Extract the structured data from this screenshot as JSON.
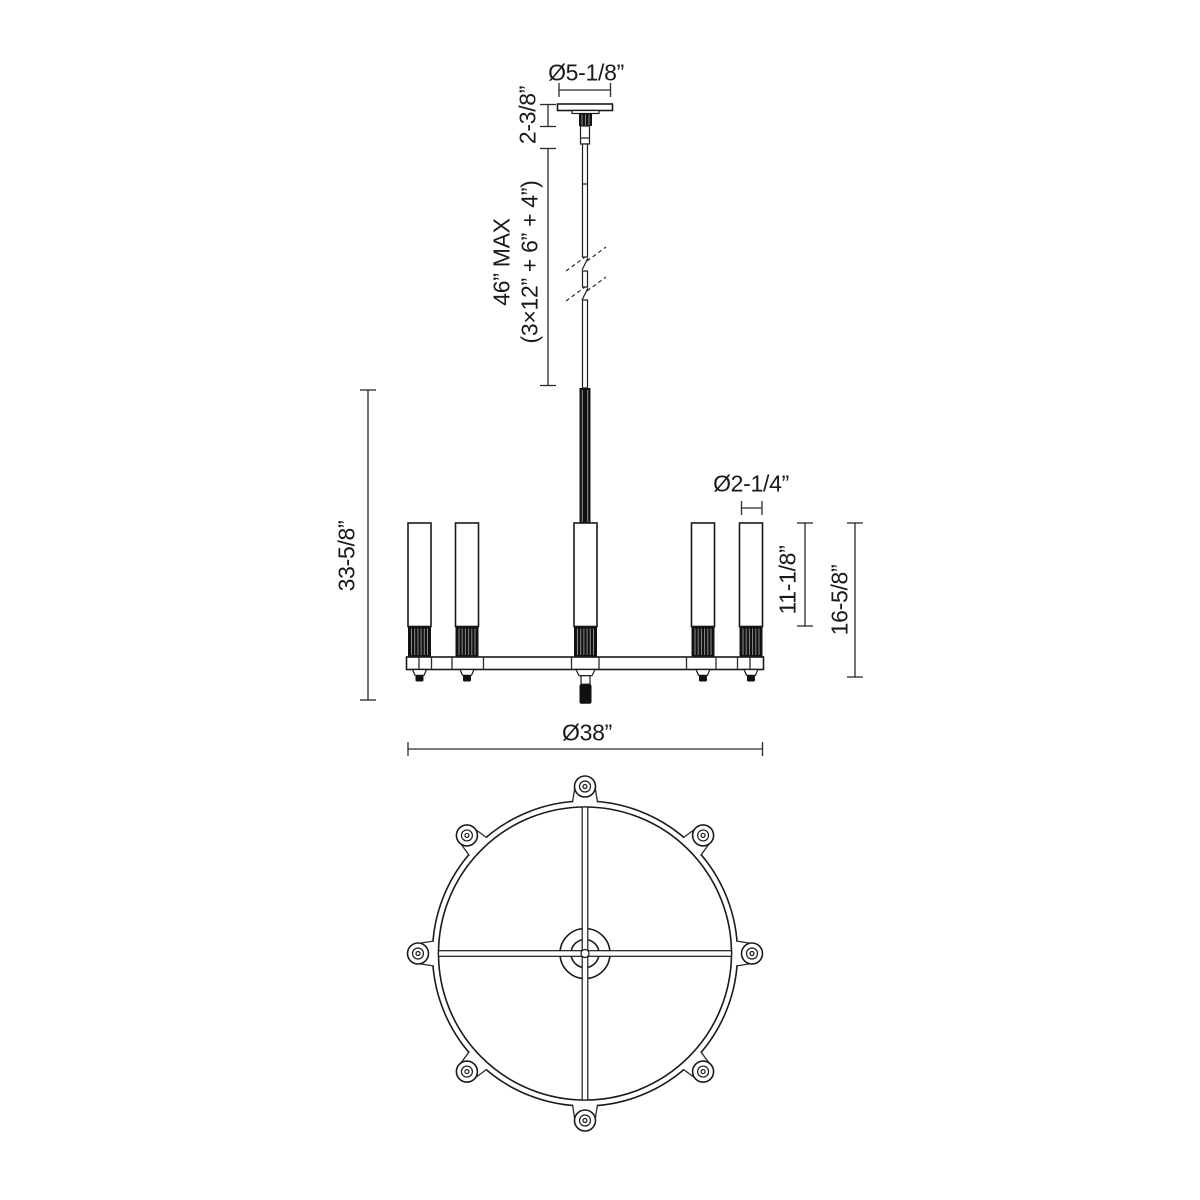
{
  "drawing": {
    "kind": "chandelier dimension diagram",
    "colors": {
      "line": "#1a1a1a",
      "black_parts": "#111111",
      "background": "#ffffff"
    },
    "elevation": {
      "visible_lamp_count": 5
    },
    "plan": {
      "lamp_lug_count": 8
    }
  },
  "labels": {
    "canopy_diameter": "Ø5-1/8”",
    "canopy_height": "2-3/8”",
    "suspension_max": "46” MAX",
    "suspension_breakdown": "(3×12” + 6” + 4”)",
    "overall_height": "33-5/8”",
    "glass_diameter": "Ø2-1/4”",
    "glass_height": "11-1/8”",
    "body_height": "16-5/8”",
    "fixture_diameter": "Ø38”"
  }
}
